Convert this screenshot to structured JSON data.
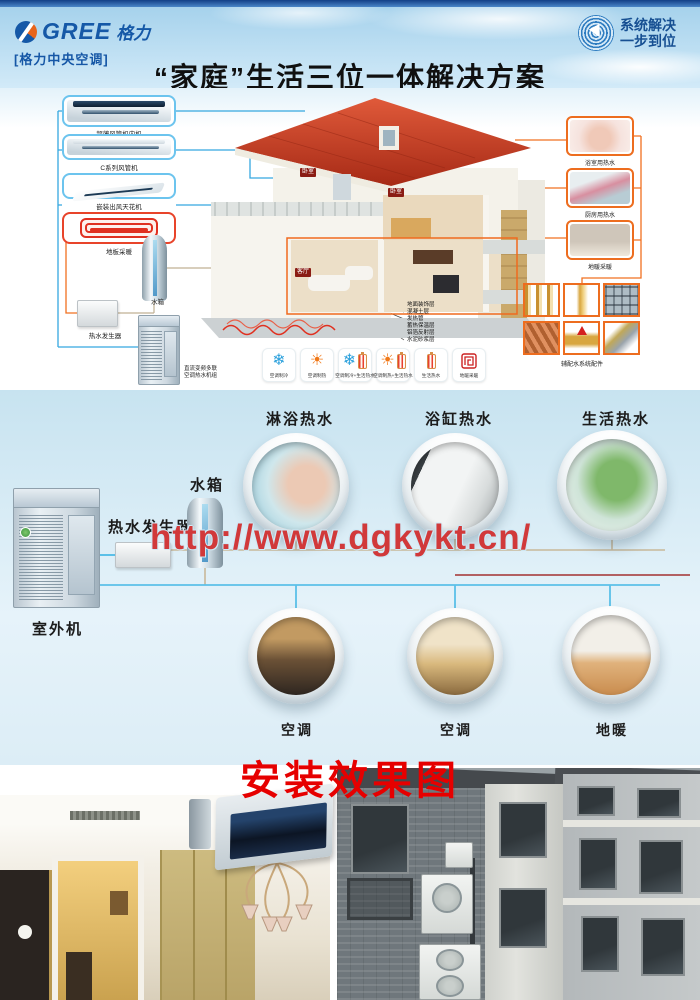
{
  "header": {
    "brand": "GREE",
    "brand_script": "格力",
    "brand_sub": "[格力中央空调]",
    "badge_line1": "系统解决",
    "badge_line2": "一步到位",
    "title": "“家庭”生活三位一体解决方案"
  },
  "diagram": {
    "left_products": [
      {
        "label": "超薄风管机内机"
      },
      {
        "label": "C系列风管机"
      },
      {
        "label": "嵌装出风天花机"
      },
      {
        "label": "地板采暖"
      }
    ],
    "tank_label": "水箱",
    "generator_label": "热水发生器",
    "outdoor_label_line1": "直流变频多联",
    "outdoor_label_line2": "空调热水机组",
    "rooms": [
      "卧室",
      "卧室",
      "客厅"
    ],
    "floor_layers": [
      "地面装饰层",
      "混凝土层",
      "发热管",
      "蓄热保温层",
      "铝箔反射层",
      "水泥砂浆层"
    ],
    "right_photos": [
      {
        "label": "浴室用热水"
      },
      {
        "label": "厨房用热水"
      },
      {
        "label": "地暖采暖"
      }
    ],
    "accessories_label": "辅配水系统配件",
    "modes": [
      {
        "glyph": "❄",
        "label": "空调制冷"
      },
      {
        "glyph": "☀",
        "label": "空调制热"
      },
      {
        "glyph": "❄",
        "label": "空调制冷+生活热水"
      },
      {
        "glyph": "☀",
        "label": "空调制热+生活热水"
      },
      {
        "glyph": "",
        "label": "生活热水"
      },
      {
        "glyph": "",
        "label": "地暖采暖"
      }
    ]
  },
  "system": {
    "outdoor_label": "室外机",
    "generator_label": "热水发生器",
    "tank_label": "水箱",
    "top_circles": [
      "淋浴热水",
      "浴缸热水",
      "生活热水"
    ],
    "bottom_circles": [
      "空调",
      "空调",
      "地暖"
    ],
    "watermark": "http://www.dgkykt.cn/"
  },
  "footer": {
    "heading": "安装效果图"
  }
}
